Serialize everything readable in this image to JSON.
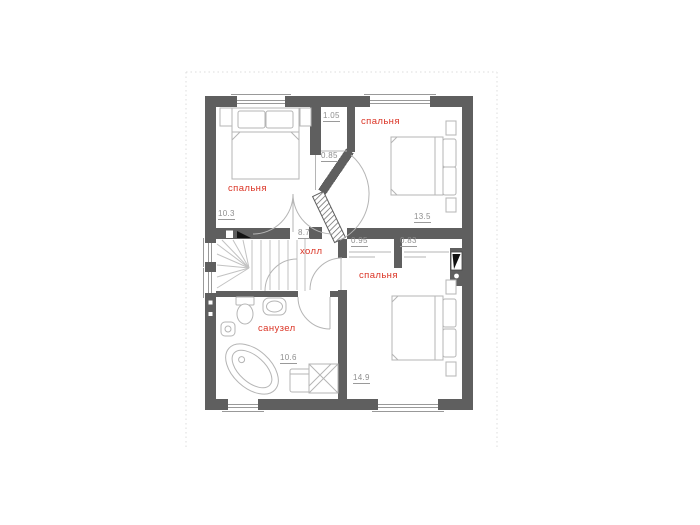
{
  "image_type": "floor plan",
  "colors": {
    "wall": "#5f5f5f",
    "room_label": "#db3425",
    "dimension_text": "#8e8e8e",
    "furniture_line": "#b5b5b5",
    "page_boundary": "#dcdcdc"
  },
  "rooms": {
    "bedroom_tl": {
      "label": "спальня",
      "area": "10.3"
    },
    "bedroom_tr": {
      "label": "спальня",
      "area": "13.5"
    },
    "bedroom_br": {
      "label": "спальня",
      "area": "14.9"
    },
    "hall": {
      "label": "холл",
      "area": "8.7"
    },
    "bathroom": {
      "label": "санузел",
      "area": "10.6"
    }
  },
  "dimensions": {
    "closet_top": "1.05",
    "niche": "0.85",
    "wardrobe_left": "0.95",
    "wardrobe_right": "0.83"
  }
}
